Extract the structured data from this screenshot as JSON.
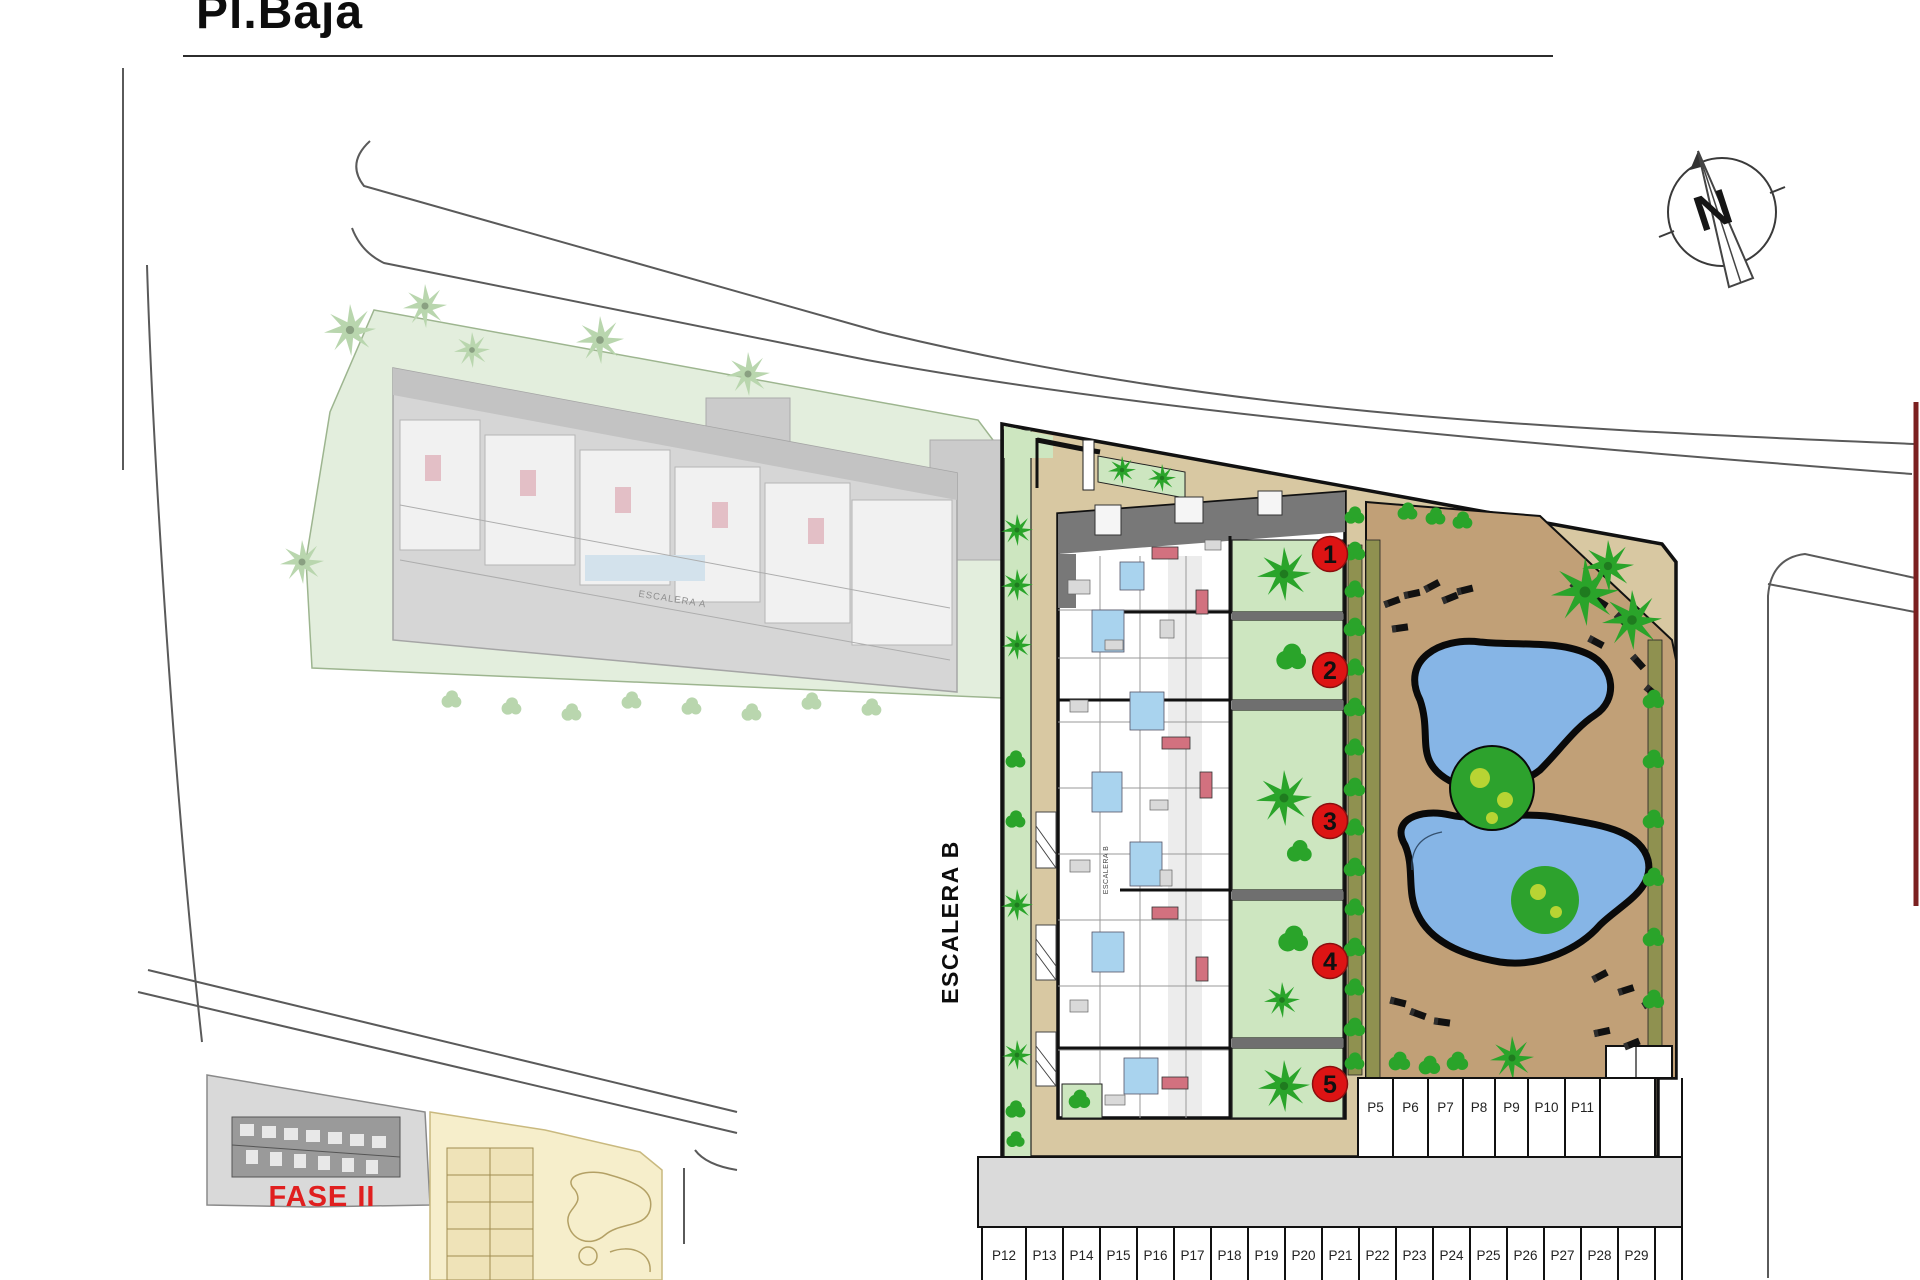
{
  "page": {
    "title": "Pl.Baja"
  },
  "compass": {
    "label": "N"
  },
  "labels": {
    "escalera_a": "ESCALERA A",
    "escalera_b_small": "ESCALERA B",
    "escalera_b": "ESCALERA B",
    "fase_2": "FASE II"
  },
  "unit_markers": [
    "1",
    "2",
    "3",
    "4",
    "5"
  ],
  "parking": {
    "top_row": [
      "P5",
      "P6",
      "P7",
      "P8",
      "P9",
      "P10",
      "P11"
    ],
    "bottom_row": [
      "P12",
      "P13",
      "P14",
      "P15",
      "P16",
      "P17",
      "P18",
      "P19",
      "P20",
      "P21",
      "P22",
      "P23",
      "P24",
      "P25",
      "P26",
      "P27",
      "P28",
      "P29"
    ]
  },
  "colors": {
    "marker_red": "#dd1414",
    "fase_red": "#e01f1f",
    "pool_blue": "#86b5e6",
    "deck_brown": "#c1a077",
    "walkway_tan": "#d8c8a2",
    "garden_green": "#cde6c0",
    "tree_green": "#2aa42a",
    "olive_strip": "#8f9150",
    "faded_site_green": "#e3eedd",
    "faded_tree_green": "#b9d6ae",
    "road_gray": "#dadada",
    "boundary_red": "#7b2020"
  }
}
